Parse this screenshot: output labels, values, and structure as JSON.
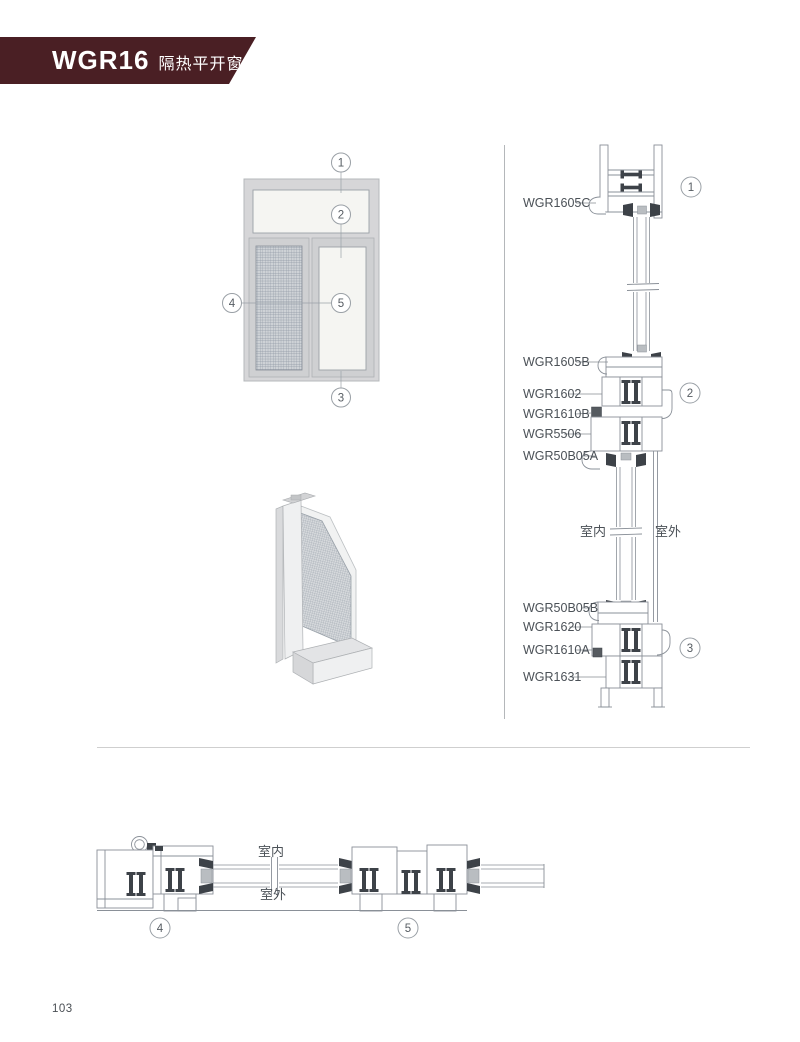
{
  "header": {
    "model": "WGR16",
    "series_name": "隔热平开窗"
  },
  "page_number": "103",
  "elevation": {
    "callouts": [
      "1",
      "2",
      "3",
      "4",
      "5"
    ]
  },
  "vertical_section": {
    "callouts": [
      "1",
      "2",
      "3"
    ],
    "labels": [
      "WGR1605C",
      "WGR1605B",
      "WGR1602",
      "WGR1610B",
      "WGR5506",
      "WGR50B05A",
      "WGR50B05B",
      "WGR1620",
      "WGR1610A",
      "WGR1631"
    ],
    "interior_label": "室内",
    "exterior_label": "室外"
  },
  "horizontal_section": {
    "callouts": [
      "4",
      "5"
    ],
    "interior_label": "室内",
    "exterior_label": "室外"
  },
  "colors": {
    "banner": "#4A1F24",
    "drawing_line": "#8A9098",
    "dark_detail": "#3D4248",
    "label_text": "#4B5157"
  }
}
